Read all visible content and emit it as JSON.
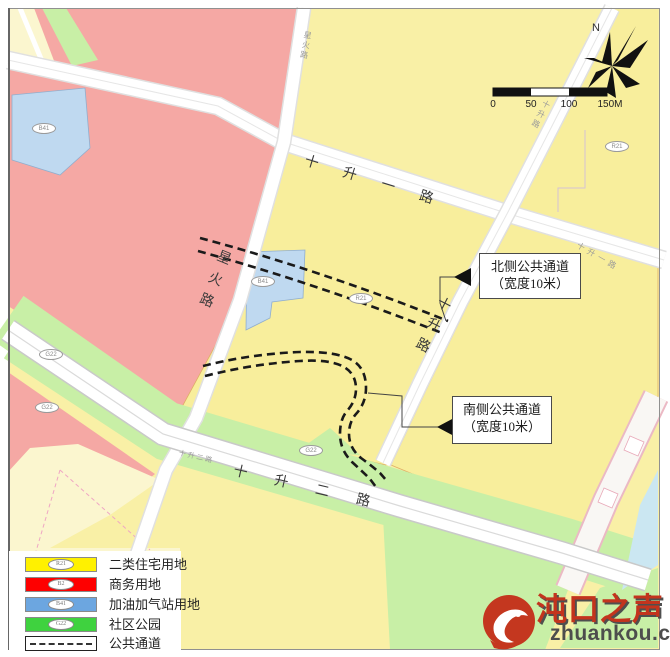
{
  "map": {
    "roads": {
      "shishengyilu_main": "十升一路",
      "shishengyilu_small": "十升一路",
      "shishengerlu_main": "十升二路",
      "shishengerlu_small": "十升二路",
      "shishenglu_main": "十升路",
      "shishenglu_small": "十升路",
      "xinghuolu_main": "星火路",
      "xinghuolu_small": "星火路"
    },
    "callouts": {
      "north": {
        "line1": "北侧公共通道",
        "line2": "（宽度10米）"
      },
      "south": {
        "line1": "南侧公共通道",
        "line2": "（宽度10米）"
      }
    },
    "compass": {
      "label": "N"
    },
    "scale": {
      "ticks": [
        "0",
        "50",
        "100",
        "150M"
      ]
    },
    "parcels": [
      {
        "code": "B41"
      },
      {
        "code": "B41"
      },
      {
        "code": "R21"
      },
      {
        "code": "R21"
      },
      {
        "code": "G22"
      },
      {
        "code": "G22"
      },
      {
        "code": "G22"
      }
    ]
  },
  "legend": {
    "items": [
      {
        "code": "R21",
        "label": "二类住宅用地",
        "color": "#FFF100"
      },
      {
        "code": "B2",
        "label": "商务用地",
        "color": "#FE0000"
      },
      {
        "code": "B41",
        "label": "加油加气站用地",
        "color": "#6CA6E0"
      },
      {
        "code": "G22",
        "label": "社区公园",
        "color": "#3FD23F"
      },
      {
        "code": "",
        "label": "公共通道",
        "color": "#FFFFFF"
      }
    ]
  },
  "watermark": {
    "title": "沌口之声",
    "domain": "zhuankou.com"
  },
  "colors": {
    "residential": "#F8EE9C",
    "commercial": "#F5A8A4",
    "gas_station": "#BFD9F0",
    "park": "#C8EFA6",
    "water": "#CBE7F2",
    "passage_dash": "#1A1A1A"
  }
}
